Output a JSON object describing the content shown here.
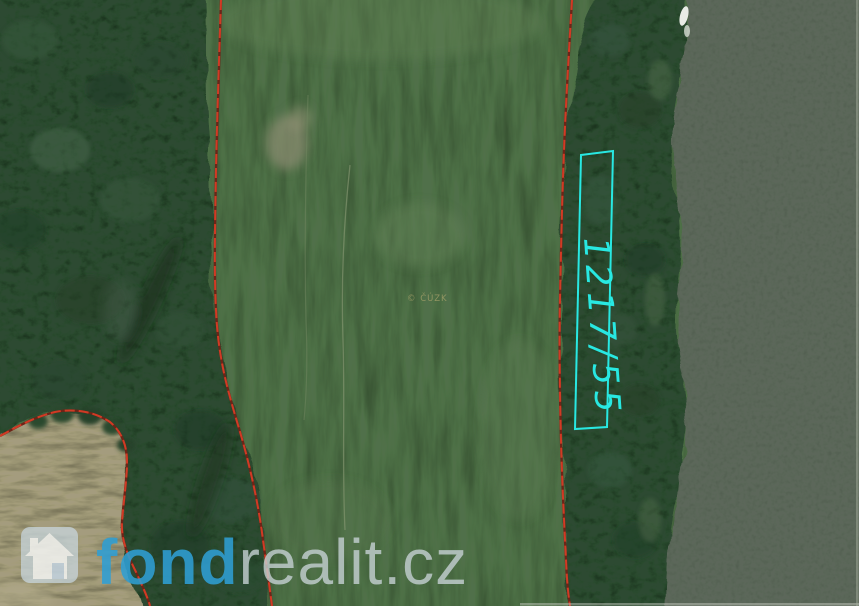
{
  "map": {
    "parcel_label": "1217/55",
    "copyright_label": "© ČÚZK",
    "colors": {
      "field_green": "#50704a",
      "forest_green": "#2d4a32",
      "water_gray_green": "#5c675a",
      "bare_field_tan": "#a49c7e",
      "boundary_red": "#d03b25",
      "parcel_cyan": "#28e8e2",
      "copyright_khaki": "#9a9a66",
      "logo_blue": "#2f9fd4",
      "logo_gray": "#c6d1d4"
    }
  },
  "watermark": {
    "brand_bold": "fond",
    "brand_rest": "realit.cz"
  }
}
